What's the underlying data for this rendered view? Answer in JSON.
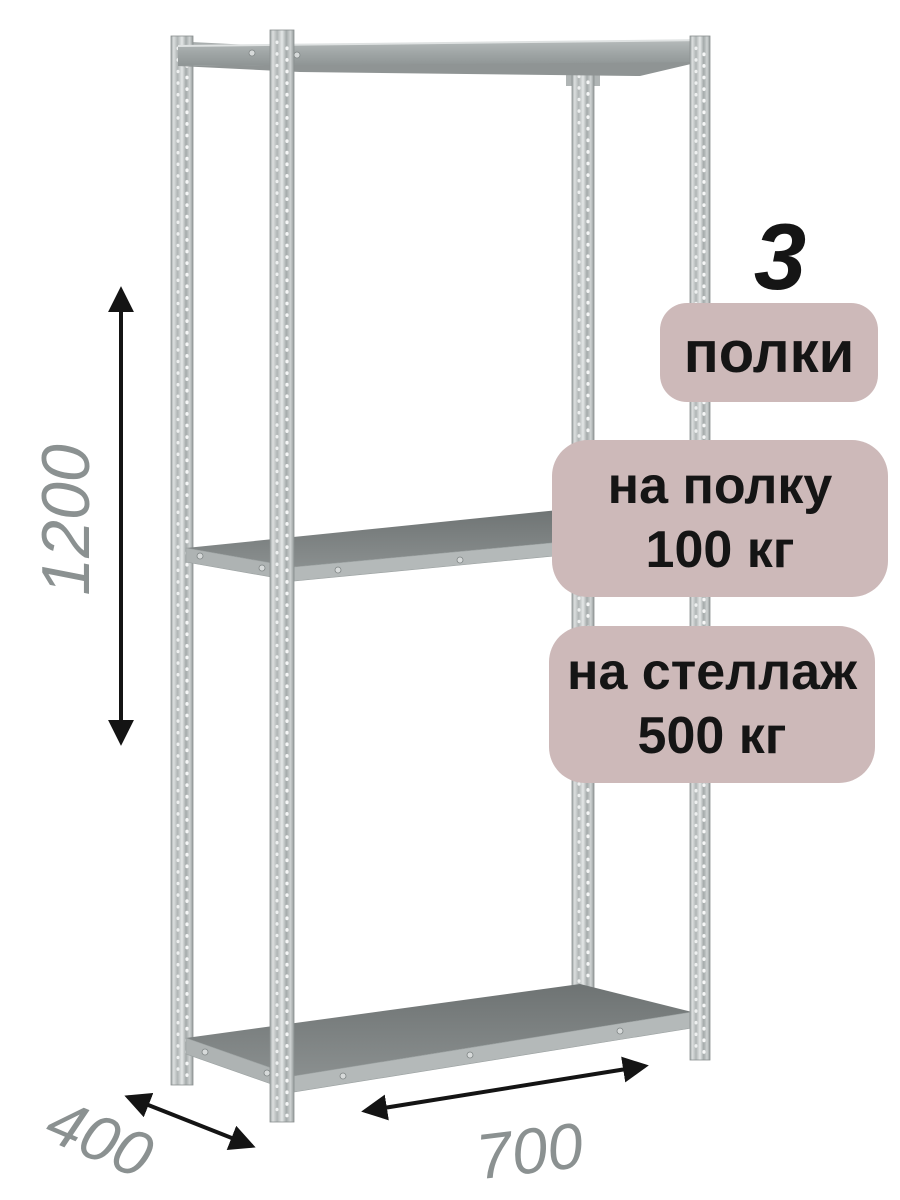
{
  "badges": {
    "count_value": "3",
    "count_label": "полки",
    "shelf_load_line1": "на полку",
    "shelf_load_line2": "100 кг",
    "rack_load_line1": "на стеллаж",
    "rack_load_line2": "500 кг"
  },
  "dimensions": {
    "height_mm": "1200",
    "depth_mm": "400",
    "width_mm": "700"
  },
  "icons": {
    "height_arrow": "double-headed-vertical-arrow",
    "depth_arrow": "double-headed-diagonal-arrow",
    "width_arrow": "double-headed-diagonal-arrow"
  },
  "colors": {
    "background": "#ffffff",
    "badge_background": "#cdb9b9",
    "badge_text": "#151515",
    "dimension_label": "#8b9191",
    "arrow": "#141414",
    "metal_light": "#c7cbcb",
    "shelf_surface": "#7d8282"
  }
}
